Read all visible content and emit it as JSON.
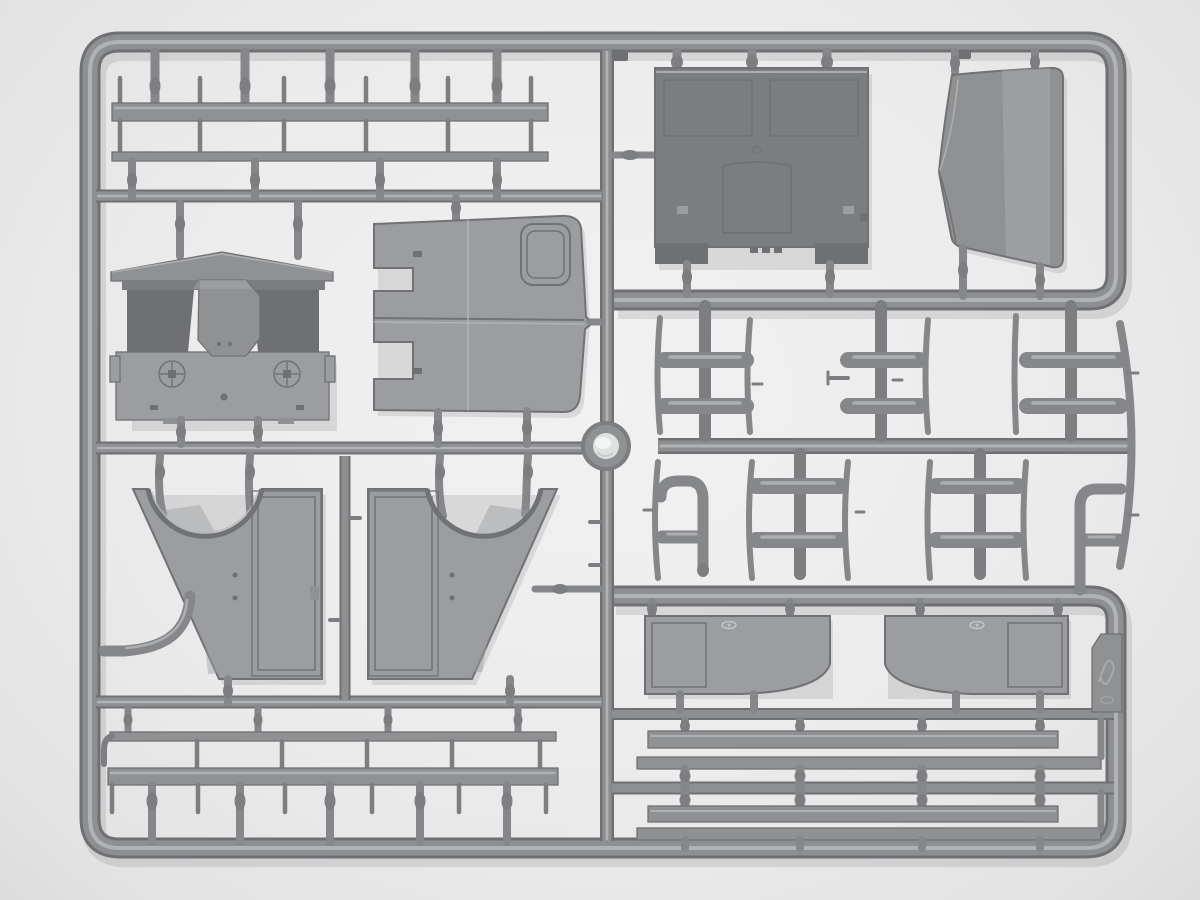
{
  "scene": {
    "type": "photograph",
    "subject": "Gray injection-molded plastic model-kit sprue (runner frame) holding unassembled truck-cab parts, photographed on a plain light background",
    "visible_text": "none (only an illegible embossed maker logo on a small tab)",
    "parts_visible": [
      "rectangular sprue frame with rounded corners",
      "round mold medallion at center",
      "two long side boards with pins (top left)",
      "cab roof / cowl piece with hood bulge and two round gauges",
      "cab rear wall panel with rounded window opening and notched edge",
      "cab front panel with two windshield openings and central hatch",
      "curved hood top panel",
      "cross-shaped tie-rod clusters and pill-shaped rods",
      "thin curved rib strips",
      "J-shaped and F-shaped pipe pieces",
      "left and right cab side panels with wheel-arch cutouts and door openings",
      "two cab door panels with window openings and concave lower corners",
      "small embossed logo tab",
      "four long flat boards (bottom right)",
      "two long boards with pins (bottom left)"
    ]
  },
  "colors": {
    "background": "#ececec",
    "runner_dark": "#6e7073",
    "runner_mid": "#8d8f91",
    "runner_highlight": "#b6b8ba",
    "pin": "#85878a",
    "pin_dark": "#7c7e81",
    "part_light": "#9b9da0",
    "part_mid": "#8f9193",
    "part_dark": "#7b7d80",
    "part_darker": "#6e7073",
    "edge_stroke": "#707275",
    "hole": "#ededee",
    "ring_inner": "#e0e1e1",
    "shadow": "rgba(60,60,66,0.13)"
  }
}
